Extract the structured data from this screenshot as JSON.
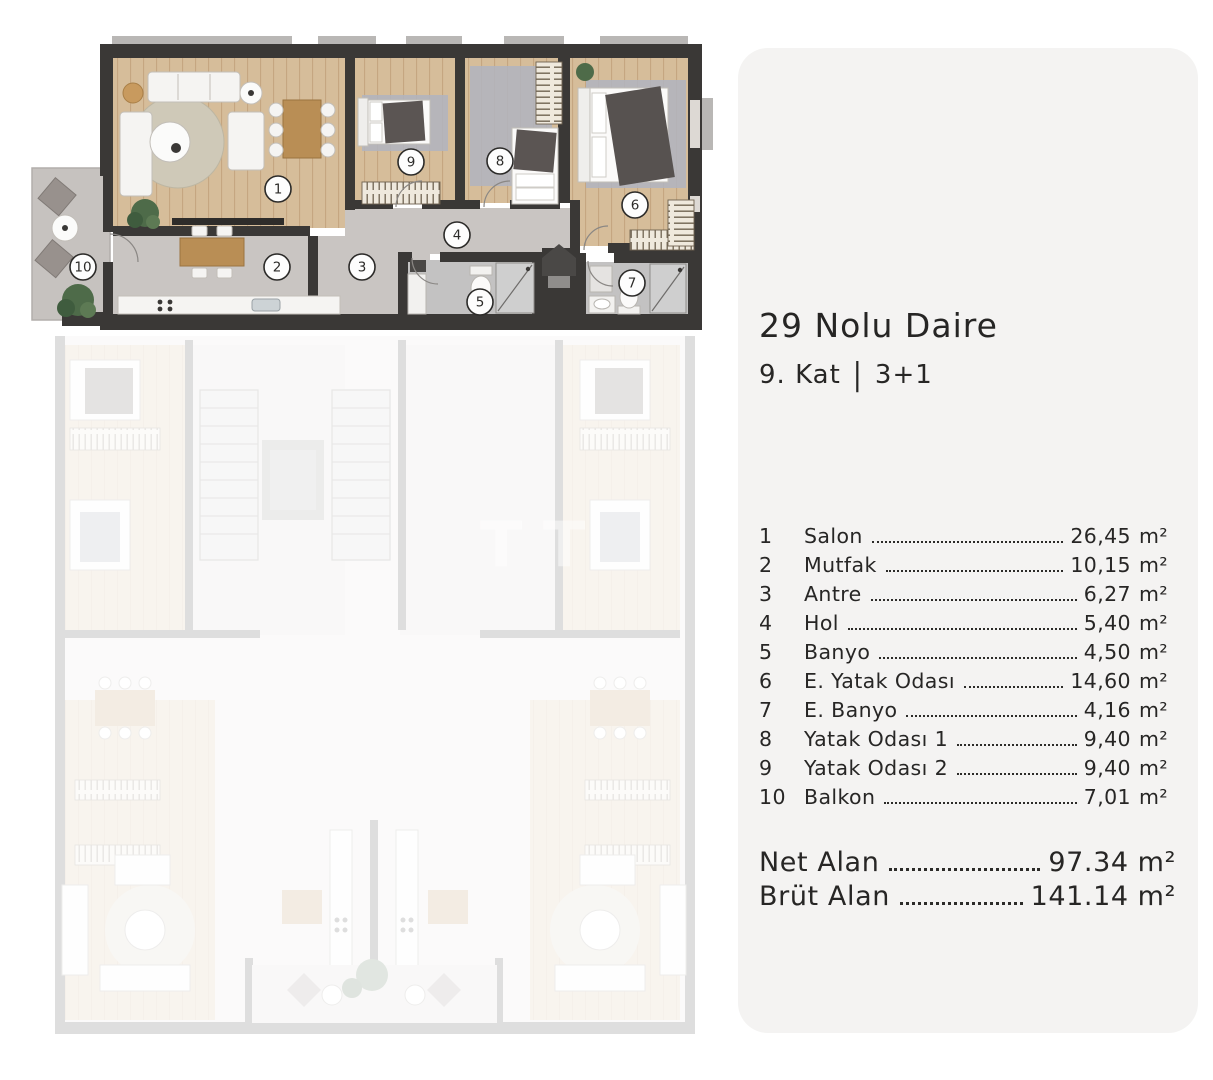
{
  "panel": {
    "title": "29 Nolu Daire",
    "floor": "9. Kat",
    "divider": "|",
    "type": "3+1",
    "rooms": [
      {
        "num": "1",
        "name": "Salon",
        "area": "26,45",
        "unit": "m²"
      },
      {
        "num": "2",
        "name": "Mutfak",
        "area": "10,15",
        "unit": "m²"
      },
      {
        "num": "3",
        "name": "Antre",
        "area": "6,27",
        "unit": "m²"
      },
      {
        "num": "4",
        "name": "Hol",
        "area": "5,40",
        "unit": "m²"
      },
      {
        "num": "5",
        "name": "Banyo",
        "area": "4,50",
        "unit": "m²"
      },
      {
        "num": "6",
        "name": "E. Yatak Odası",
        "area": "14,60",
        "unit": "m²"
      },
      {
        "num": "7",
        "name": "E. Banyo",
        "area": "4,16",
        "unit": "m²"
      },
      {
        "num": "8",
        "name": "Yatak Odası 1",
        "area": "9,40",
        "unit": "m²"
      },
      {
        "num": "9",
        "name": "Yatak Odası 2",
        "area": "9,40",
        "unit": "m²"
      },
      {
        "num": "10",
        "name": "Balkon",
        "area": "7,01",
        "unit": "m²"
      }
    ],
    "totals": [
      {
        "label": "Net Alan",
        "value": "97.34",
        "unit": "m²"
      },
      {
        "label": "Brüt Alan",
        "value": "141.14",
        "unit": "m²"
      }
    ]
  },
  "plan": {
    "labels": [
      "1",
      "2",
      "3",
      "4",
      "5",
      "6",
      "7",
      "8",
      "9",
      "10"
    ],
    "highlighted_unit": "29",
    "watermark_letters": [
      "T",
      "T",
      "E"
    ]
  },
  "colors": {
    "panel_bg": "#f4f3f2",
    "text": "#272625",
    "wall": "#3a3836",
    "wood_floor": "#d6bd9a",
    "gray_floor": "#c9c5c2",
    "bath_floor": "#c3c2c2",
    "rug": "#b0b4bf",
    "blanket": "#5b5553",
    "plant": "#4e6b49"
  }
}
